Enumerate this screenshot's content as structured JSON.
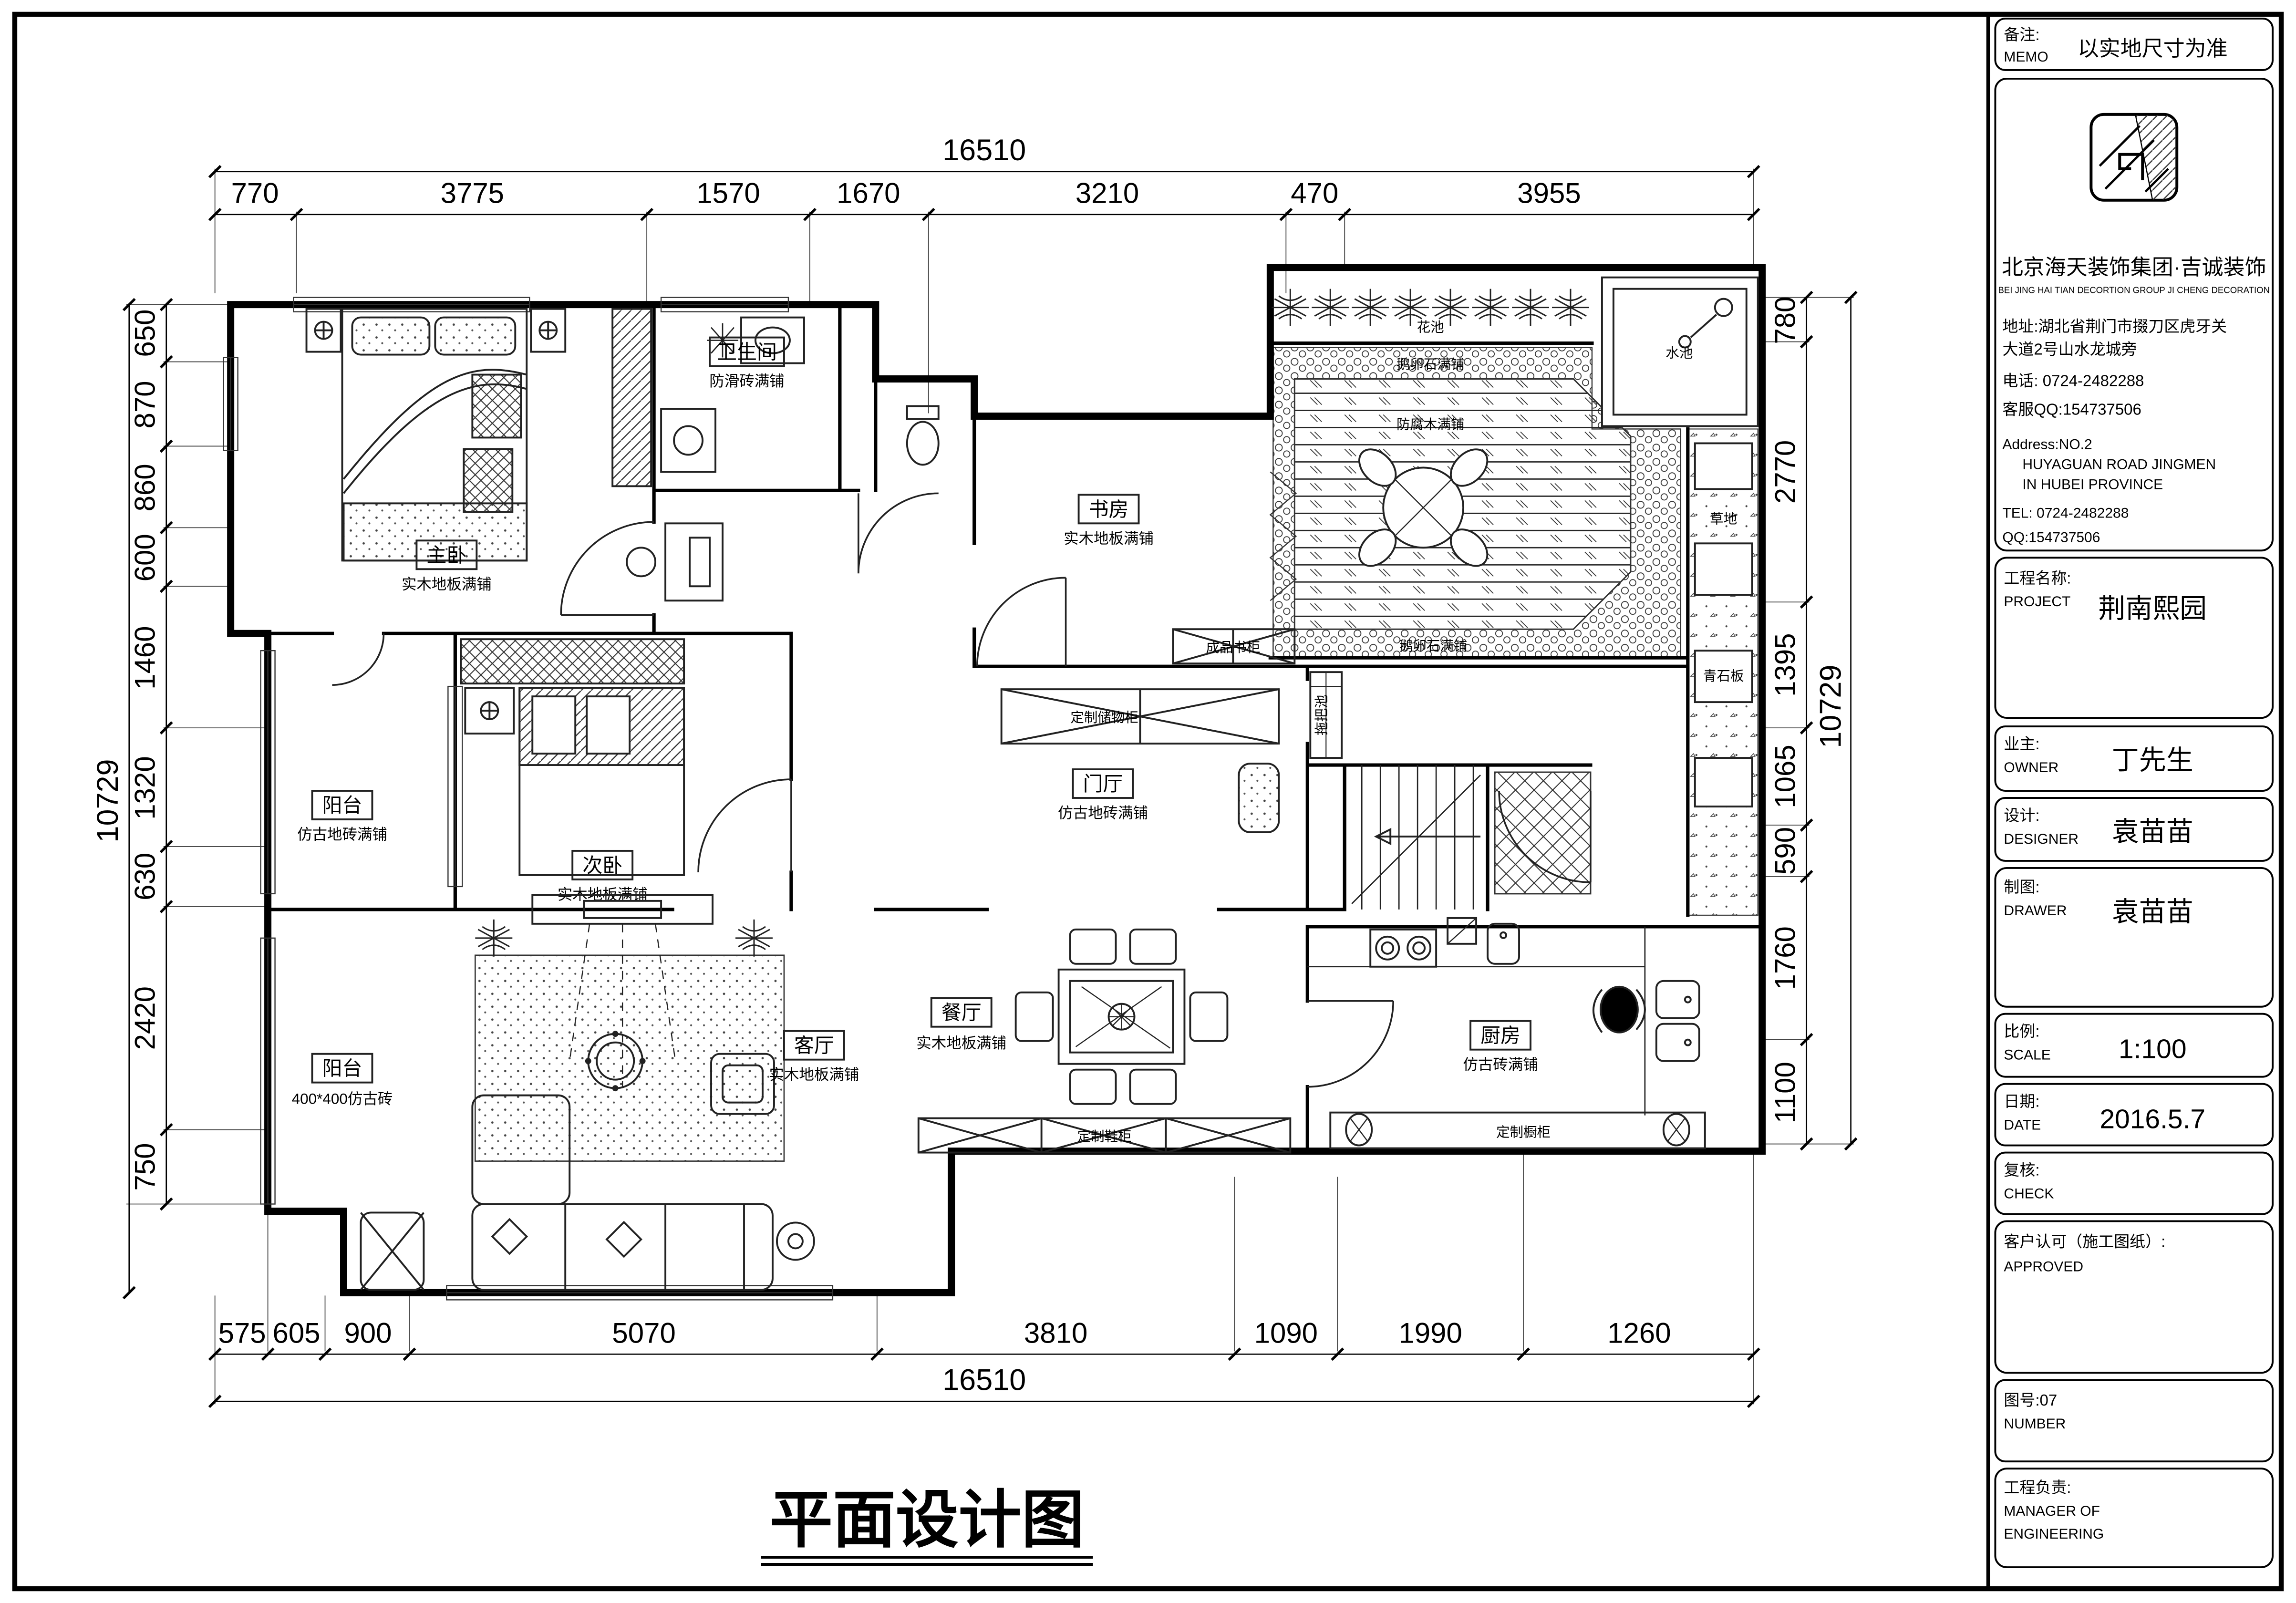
{
  "colors": {
    "line": "#000000",
    "paper": "#ffffff"
  },
  "sheet": {
    "bottom_title": "平面设计图",
    "memo": {
      "cn": "备注:",
      "en": "MEMO",
      "value": "以实地尺寸为准"
    },
    "company": {
      "name": "北京海天装饰集团·吉诚装饰",
      "name_en": "BEI JING HAI TIAN DECORTION GROUP JI CHENG DECORATION",
      "address_cn_1": "地址:湖北省荆门市掇刀区虎牙关",
      "address_cn_2": "大道2号山水龙城旁",
      "phone_cn": "电话: 0724-2482288",
      "qq_cn": "客服QQ:154737506",
      "address_en_1": "Address:NO.2",
      "address_en_2": "HUYAGUAN ROAD JINGMEN",
      "address_en_3": "IN HUBEI PROVINCE",
      "tel_en": "TEL: 0724-2482288",
      "qq_en": "QQ:154737506"
    },
    "fields": {
      "project": {
        "cn": "工程名称:",
        "en": "PROJECT",
        "value": "荆南熙园"
      },
      "owner": {
        "cn": "业主:",
        "en": "OWNER",
        "value": "丁先生"
      },
      "designer": {
        "cn": "设计:",
        "en": "DESIGNER",
        "value": "袁苗苗"
      },
      "drawer": {
        "cn": "制图:",
        "en": "DRAWER",
        "value": "袁苗苗"
      },
      "scale": {
        "cn": "比例:",
        "en": "SCALE",
        "value": "1:100"
      },
      "date": {
        "cn": "日期:",
        "en": "DATE",
        "value": "2016.5.7"
      },
      "check": {
        "cn": "复核:",
        "en": "CHECK"
      },
      "approved": {
        "cn": "客户认可（施工图纸）:",
        "en": "APPROVED"
      },
      "number": {
        "cn": "图号:07",
        "en": "NUMBER"
      },
      "manager": {
        "cn": "工程负责:",
        "en1": "MANAGER OF",
        "en2": "ENGINEERING"
      }
    }
  },
  "dims": {
    "top_total": "16510",
    "top": [
      "770",
      "3775",
      "1570",
      "1670",
      "3210",
      "470",
      "3955"
    ],
    "left_total": "10729",
    "left": [
      "650",
      "870",
      "860",
      "600",
      "1460",
      "1320",
      "630",
      "2420",
      "750"
    ],
    "right": [
      "780",
      "2770",
      "1395",
      "1065",
      "590",
      "1760",
      "1100"
    ],
    "right_total": "10729",
    "bottom": [
      "575",
      "605",
      "900",
      "5070",
      "3810",
      "1090",
      "1990",
      "1260"
    ],
    "bottom_total": "16510"
  },
  "rooms": {
    "master": {
      "name": "主卧",
      "floor": "实木地板满铺"
    },
    "bath": {
      "name": "卫生间",
      "floor": "防滑砖满铺"
    },
    "study": {
      "name": "书房",
      "floor": "实木地板满铺"
    },
    "hall": {
      "name": "门厅",
      "floor": "仿古地砖满铺"
    },
    "balcony1": {
      "name": "阳台",
      "floor": "仿古地砖满铺"
    },
    "second": {
      "name": "次卧",
      "floor": "实木地板满铺"
    },
    "living": {
      "name": "客厅",
      "floor": "实木地板满铺"
    },
    "dining": {
      "name": "餐厅",
      "floor": "实木地板满铺"
    },
    "kitchen": {
      "name": "厨房",
      "floor": "仿古砖满铺"
    },
    "balcony2": {
      "name": "阳台",
      "floor": "400*400仿古砖"
    }
  },
  "annotations": {
    "bookcase": "成品书柜",
    "storage": "定制储物柜",
    "shoe_cabinet": "定制鞋柜",
    "mop_sink": "拖把池",
    "kitchen_cabinet": "定制橱柜",
    "flower_bed": "花池",
    "pool": "水池",
    "pebble1": "鹅卵石满铺",
    "pebble2": "鹅卵石满铺",
    "deck": "防腐木满铺",
    "lawn": "草地",
    "stone": "青石板"
  }
}
